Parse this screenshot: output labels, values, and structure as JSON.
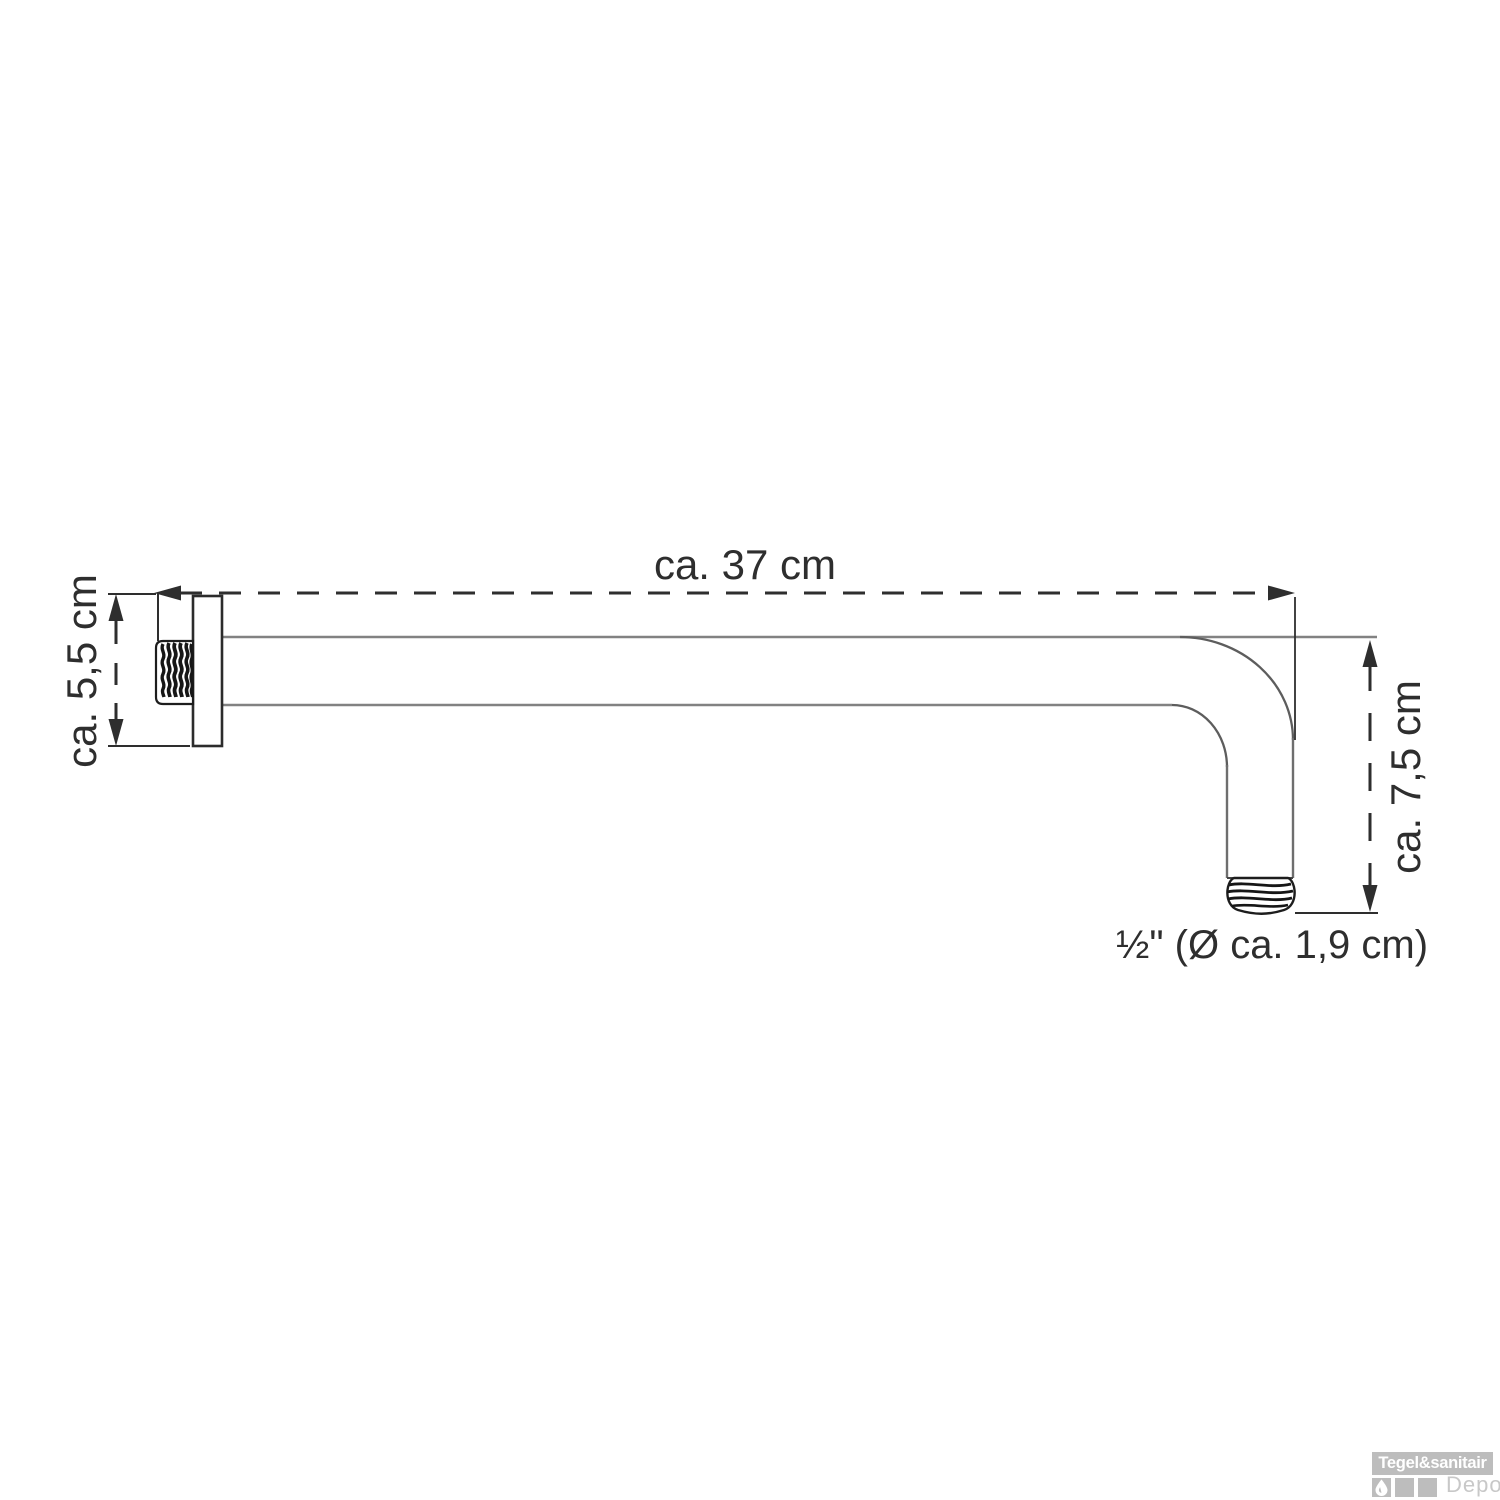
{
  "diagram": {
    "labels": {
      "dim_length": "ca. 37 cm",
      "dim_flange_height": "ca. 5,5 cm",
      "dim_drop_height": "ca. 7,5 cm",
      "thread_spec": "½\" (Ø ca. 1,9 cm)"
    },
    "colors": {
      "dimension_lines": "#2e2e2e",
      "pipe_outline": "#828282",
      "bend_curve": "#5d5d5d",
      "thread_outline": "#222222"
    }
  },
  "watermark": {
    "brand": "Tegel&sanitair",
    "sub_brand": "Depot",
    "box_color": "#bdbdbd",
    "sub_text_color": "#c8c8c8"
  }
}
